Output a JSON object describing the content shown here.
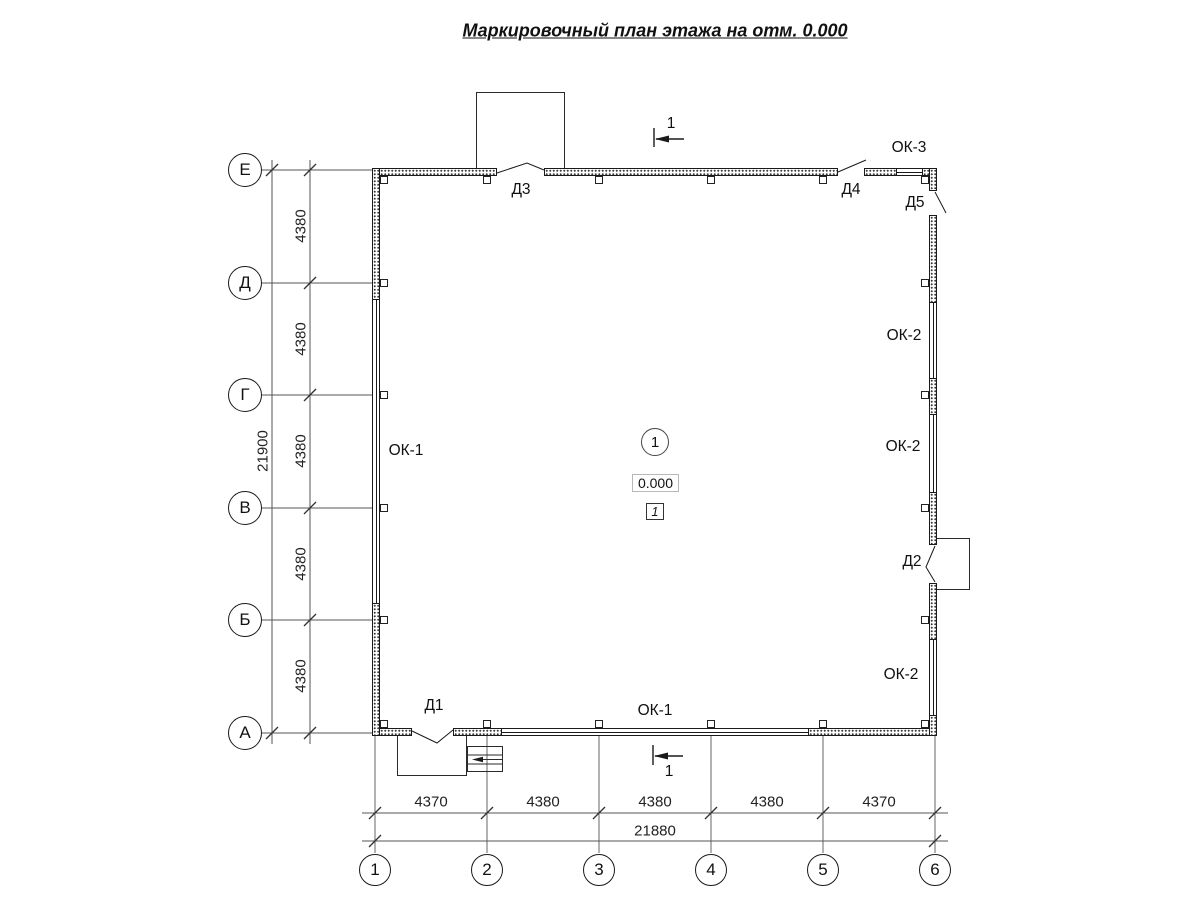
{
  "title": "Маркировочный план этажа на отм. 0.000",
  "colors": {
    "line": "#1a1a1a",
    "thin_line": "#555555"
  },
  "row_axes": {
    "labels": [
      "Е",
      "Д",
      "Г",
      "В",
      "Б",
      "А"
    ],
    "segment_dims": [
      "4380",
      "4380",
      "4380",
      "4380",
      "4380"
    ],
    "total": "21900"
  },
  "col_axes": {
    "labels": [
      "1",
      "2",
      "3",
      "4",
      "5",
      "6"
    ],
    "segment_dims": [
      "4370",
      "4380",
      "4380",
      "4380",
      "4370"
    ],
    "total": "21880"
  },
  "labels": {
    "ok1": "ОК-1",
    "ok2": "ОК-2",
    "ok3": "ОК-3",
    "d1": "Д1",
    "d2": "Д2",
    "d3": "Д3",
    "d4": "Д4",
    "d5": "Д5"
  },
  "room": {
    "number": "1",
    "elevation": "0.000",
    "finish": "1"
  },
  "section": {
    "label": "1"
  }
}
